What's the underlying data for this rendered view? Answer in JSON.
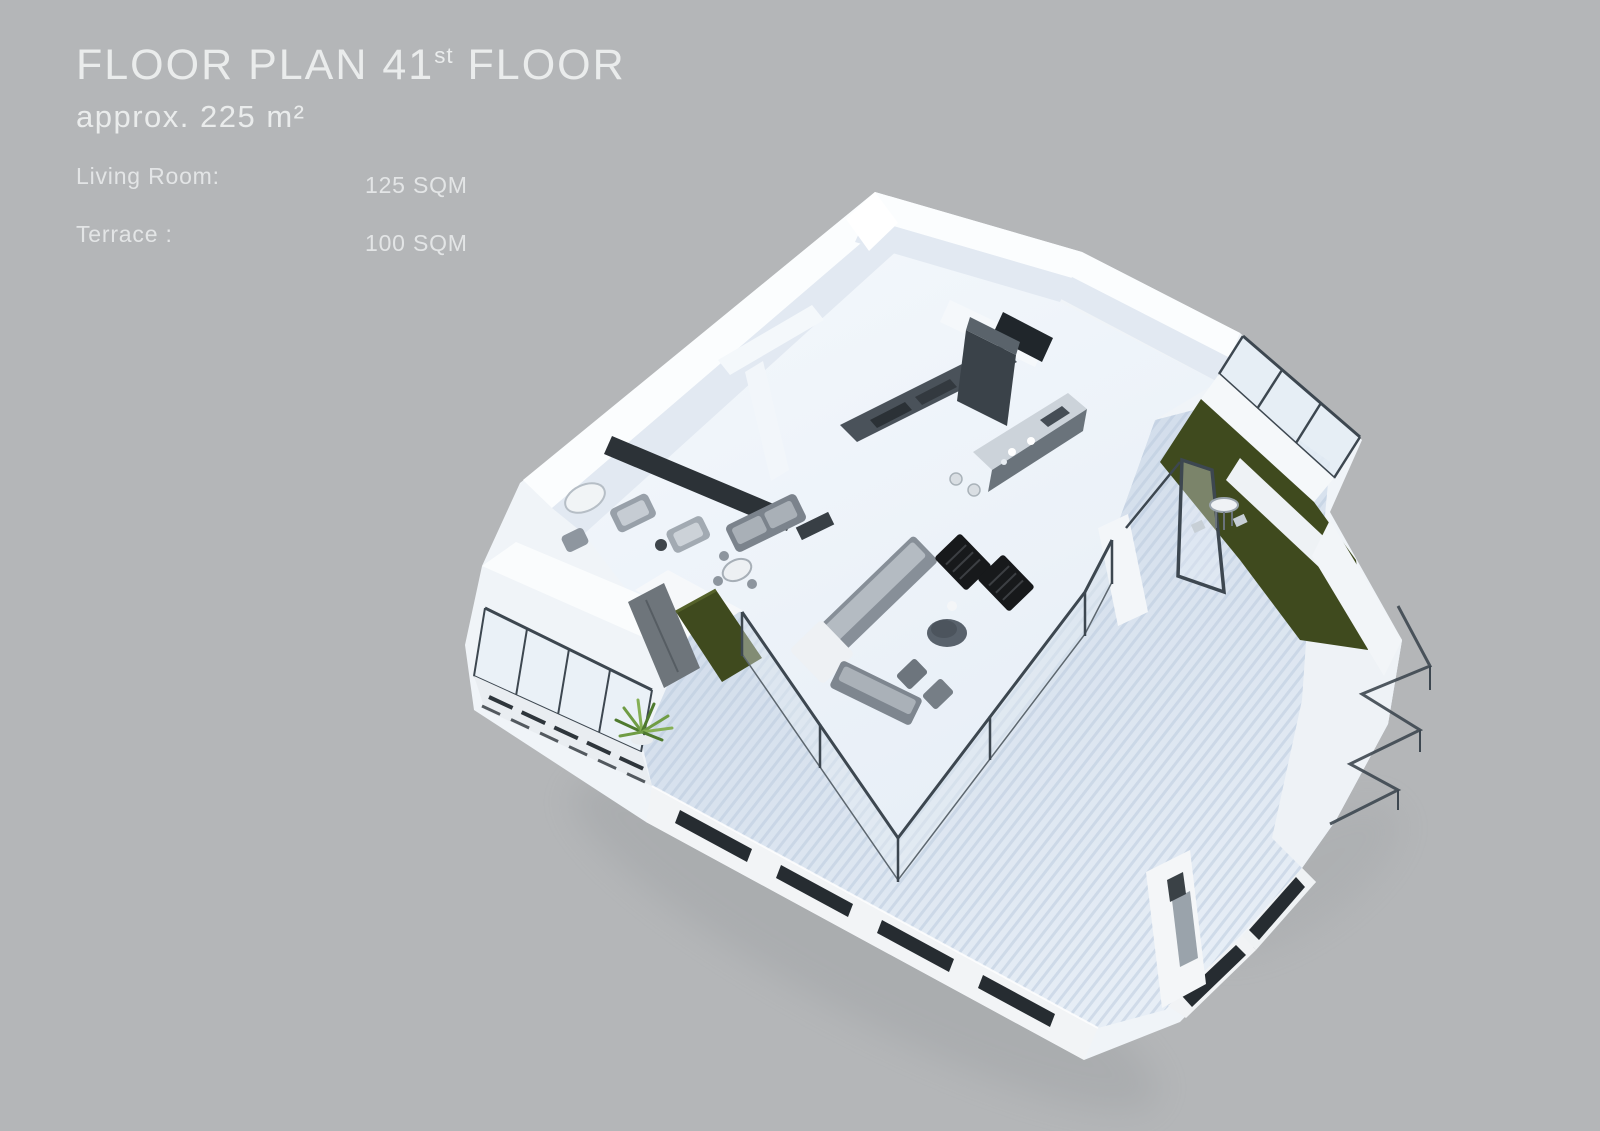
{
  "page": {
    "background": "#b4b6b8"
  },
  "header": {
    "title": {
      "prefix": "FLOOR PLAN 41",
      "superscript": "st",
      "suffix": " FLOOR"
    },
    "subtitle": "approx. 225 m²",
    "specs": [
      {
        "label": "Living Room:",
        "value": "125 SQM"
      },
      {
        "label": "Terrace :",
        "value": "100 SQM"
      }
    ]
  },
  "floor_plan": {
    "type": "3d-isometric-rendering",
    "caption": "3D floor plan rendering of the 41st floor penthouse with living room, open kitchen, lounge seating, hedge planters, glass balustrades and wrap-around deck terrace"
  },
  "palette": {
    "bg": "#b4b6b8",
    "text": "#eaecec",
    "text-dim": "#e3e5e6",
    "wall-top": "#fbfdfe",
    "wall-face": "#e2e9f2",
    "floor": "#eef3f9",
    "deck-a": "#c9d6e6",
    "deck-b": "#e7eef6",
    "stripe": "#b9c9dd",
    "hedge": "#3f4a1e",
    "hedge-light": "#55622a",
    "frame": "#3d4750",
    "glass": "#e4ecf4",
    "fascia": "#f2f4f6",
    "slot": "#262c31",
    "furn-dark": "#17191b",
    "furn-gray": "#848c95"
  }
}
